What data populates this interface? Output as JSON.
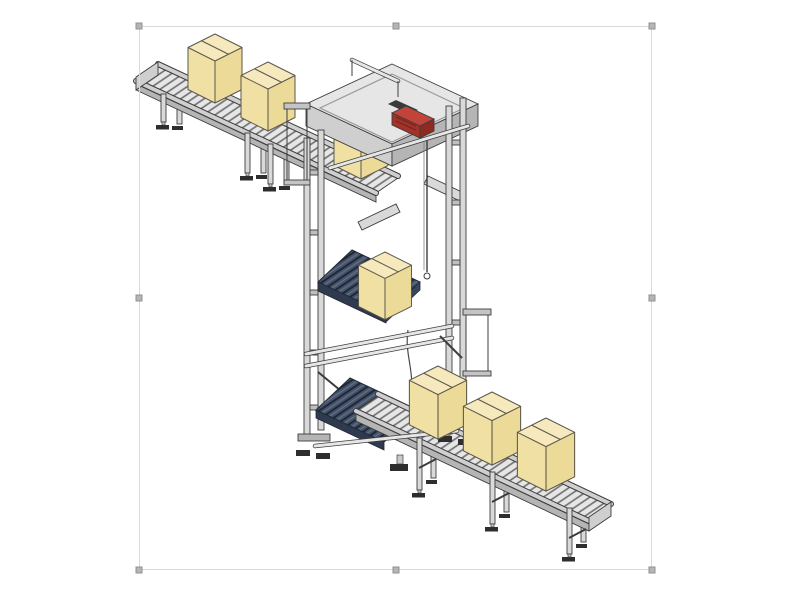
{
  "page": {
    "background": "#ffffff"
  },
  "selection": {
    "frame": {
      "left": 139,
      "top": 26,
      "width": 513,
      "height": 544
    },
    "border_color": "#d9d9d9",
    "bottom_border_color": "#cfe0cc",
    "handle_fill": "#b4b6b4",
    "handle_border": "#8f918f",
    "handles": [
      {
        "name": "resize-handle-top-left",
        "x": 139,
        "y": 26
      },
      {
        "name": "resize-handle-top-center",
        "x": 396,
        "y": 26
      },
      {
        "name": "resize-handle-top-right",
        "x": 652,
        "y": 26
      },
      {
        "name": "resize-handle-middle-left",
        "x": 139,
        "y": 298
      },
      {
        "name": "resize-handle-middle-right",
        "x": 652,
        "y": 298
      },
      {
        "name": "resize-handle-bottom-left",
        "x": 139,
        "y": 570
      },
      {
        "name": "resize-handle-bottom-center",
        "x": 396,
        "y": 570
      },
      {
        "name": "resize-handle-bottom-right",
        "x": 652,
        "y": 570
      }
    ]
  },
  "diagram": {
    "type": "isometric-technical-illustration",
    "subject": "vertical-box-lift-with-infeed-and-outfeed-roller-conveyors",
    "colors": {
      "line": "#3d3d3d",
      "frame_light": "#e6e6e6",
      "frame_mid": "#cfcfcf",
      "frame_dark": "#b5b5b5",
      "roller_bed": "#e6e6e6",
      "roller_line": "#6e6e6e",
      "slat_dark": "#46536a",
      "slat_line": "#1f2836",
      "slat_face": "#2f3a4e",
      "red_accent": "#c0443a",
      "red_dark": "#8f2a20",
      "foot_dark": "#2e2e2e",
      "box_top": "#f5e9bd",
      "box_left": "#f0e0a4",
      "box_right": "#ecda98",
      "box_outline": "#5d574a",
      "frame_border": "#d9d9d9",
      "frame_border_bottom": "#cfe0cc",
      "handle_fill": "#b4b6b4",
      "handle_border": "#8f918f"
    },
    "boxes": [
      {
        "id": "carton-box-1",
        "layer": "upper",
        "x": 215,
        "y": 34,
        "s": 1.0
      },
      {
        "id": "carton-box-2",
        "layer": "upper",
        "x": 268,
        "y": 62,
        "s": 1.0
      },
      {
        "id": "carton-box-3",
        "layer": "upper",
        "x": 361,
        "y": 110,
        "s": 1.0
      },
      {
        "id": "carton-box-4",
        "layer": "lower",
        "x": 385,
        "y": 252,
        "s": 0.98
      },
      {
        "id": "carton-box-5",
        "layer": "lower",
        "x": 438,
        "y": 366,
        "s": 1.06
      },
      {
        "id": "carton-box-6",
        "layer": "lower",
        "x": 492,
        "y": 392,
        "s": 1.06
      },
      {
        "id": "carton-box-7",
        "layer": "lower",
        "x": 546,
        "y": 418,
        "s": 1.06
      }
    ]
  }
}
